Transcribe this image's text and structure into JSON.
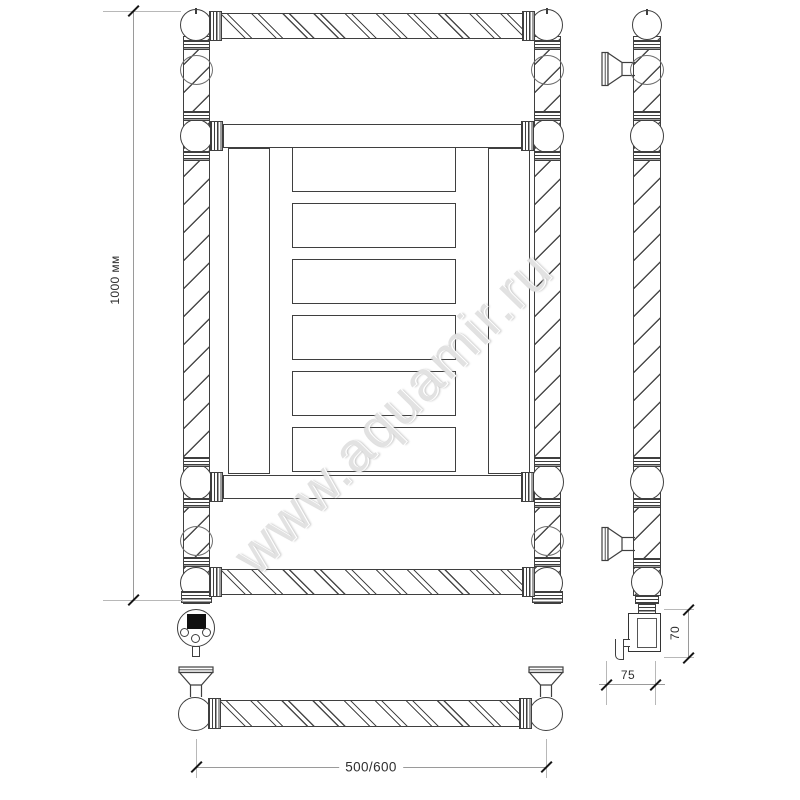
{
  "watermark": {
    "text": "www.aquamir.ru"
  },
  "dimensions": {
    "height": "1000 мм",
    "width": "500/600",
    "element_box_height": "70",
    "element_box_depth": "75"
  },
  "colors": {
    "line": "#3f3f3f",
    "dimension_line": "#9a9a9a",
    "text": "#2f2f2f",
    "watermark": "#cbcbcb",
    "background": "#ffffff"
  }
}
